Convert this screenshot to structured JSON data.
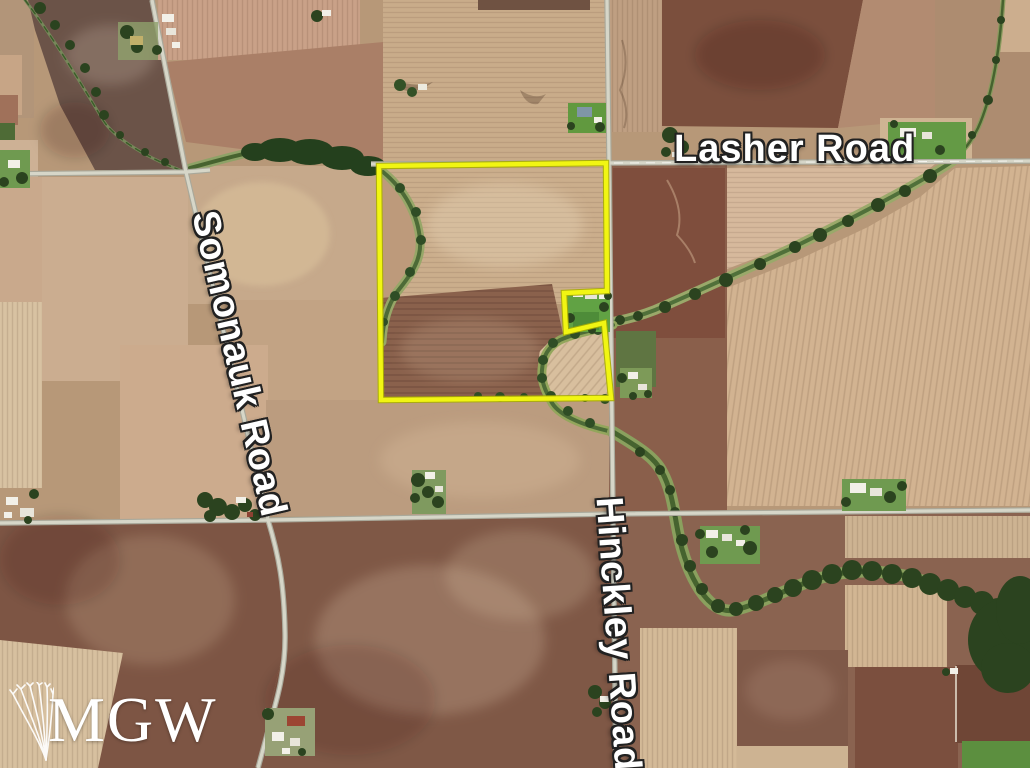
{
  "map": {
    "description": "Aerial parcel map of farmland",
    "road_labels": [
      {
        "id": "lasher",
        "text": "Lasher Road"
      },
      {
        "id": "somonauk",
        "text": "Somonauk Road"
      },
      {
        "id": "hinckley",
        "text": "Hinckley Road"
      }
    ],
    "watermark": {
      "text": "MGW",
      "icon": "wheat-icon"
    },
    "colors": {
      "parcel_outline": "#f1f513",
      "road_label_fill": "#ffffff",
      "road_label_outline": "#212121",
      "watermark_fill": "#ffffff",
      "field_pale": "#d2b391",
      "field_brown": "#7d5544",
      "tree_green": "#2b431f"
    }
  }
}
